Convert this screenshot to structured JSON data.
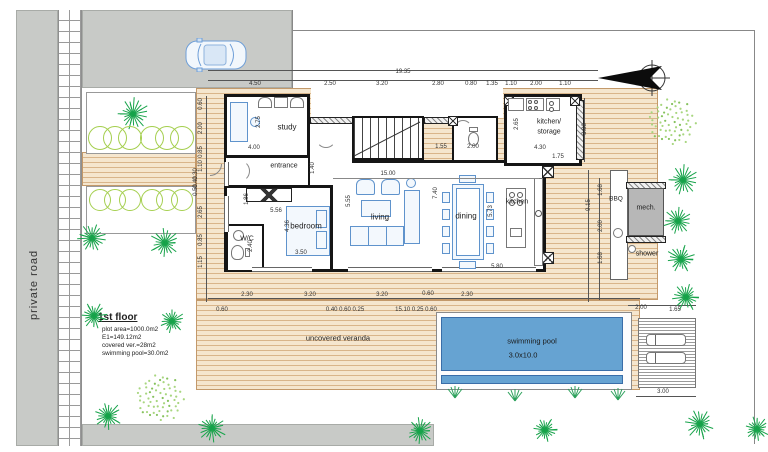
{
  "labels": {
    "road": "private road",
    "veranda": "uncovered veranda",
    "rooms": {
      "study": "study",
      "entrance": "entrance",
      "bedroom": "bedroom",
      "wc": "W/C",
      "living": "living",
      "dining": "dining",
      "kitchen": "kitchen",
      "kitchen_storage_1": "kitchen/",
      "kitchen_storage_2": "storage",
      "mech": "mech.",
      "shower": "shower",
      "bbq": "BBQ"
    },
    "pool": {
      "name": "swimming pool",
      "size": "3.0x10.0"
    }
  },
  "info_block": {
    "title": "1st floor",
    "lines": [
      "plot area=1000.0m2",
      "E1=149.12m2",
      "covered ver.=28m2",
      "swimming pool=30.0m2"
    ]
  },
  "dimensions": {
    "total_width": "19.35",
    "top_chain": [
      "4.50",
      "2.50",
      "3.20",
      "2.80",
      "0.80",
      "1.35",
      "1.10",
      "2.00",
      "1.10"
    ],
    "bottom_chain": [
      "2.30",
      "3.20",
      "3.20",
      "0.60",
      "2.30"
    ],
    "bottom_sub": [
      "0.60",
      "0.40 0.60 0.25",
      "15.10 0.25 0.60"
    ],
    "left_chain": [
      "0.60",
      "2.00",
      "0.85",
      "1.10",
      "0.30",
      "0.40",
      "0.50",
      "2.65",
      "0.85",
      "1.15"
    ],
    "right_chain": [
      "3.88",
      "9.15",
      "1.68",
      "2.00",
      "1.68"
    ],
    "pool_chain": [
      "2.00",
      "1.65",
      "3.00"
    ]
  },
  "dim_labels": [
    {
      "t": "19.35",
      "x": 403,
      "y": 72,
      "v": false
    },
    {
      "t": "4.50",
      "x": 255,
      "y": 84,
      "v": false
    },
    {
      "t": "2.50",
      "x": 330,
      "y": 84,
      "v": false
    },
    {
      "t": "3.20",
      "x": 382,
      "y": 84,
      "v": false
    },
    {
      "t": "2.80",
      "x": 438,
      "y": 84,
      "v": false
    },
    {
      "t": "0.80",
      "x": 471,
      "y": 84,
      "v": false
    },
    {
      "t": "1.35",
      "x": 492,
      "y": 84,
      "v": false
    },
    {
      "t": "1.10",
      "x": 511,
      "y": 84,
      "v": false
    },
    {
      "t": "2.00",
      "x": 536,
      "y": 84,
      "v": false
    },
    {
      "t": "1.10",
      "x": 565,
      "y": 84,
      "v": false
    },
    {
      "t": "2.30",
      "x": 247,
      "y": 295,
      "v": false
    },
    {
      "t": "3.20",
      "x": 310,
      "y": 295,
      "v": false
    },
    {
      "t": "3.20",
      "x": 382,
      "y": 295,
      "v": false
    },
    {
      "t": "0.60",
      "x": 428,
      "y": 294,
      "v": false
    },
    {
      "t": "2.30",
      "x": 467,
      "y": 295,
      "v": false
    },
    {
      "t": "0.60",
      "x": 222,
      "y": 310,
      "v": false
    },
    {
      "t": "0.40 0.60 0.25",
      "x": 345,
      "y": 310,
      "v": false
    },
    {
      "t": "15.10 0.25 0.60",
      "x": 416,
      "y": 310,
      "v": false
    },
    {
      "t": "0.60",
      "x": 201,
      "y": 104,
      "v": true
    },
    {
      "t": "2.00",
      "x": 201,
      "y": 128,
      "v": true
    },
    {
      "t": "0.85",
      "x": 201,
      "y": 152,
      "v": true
    },
    {
      "t": "1.10",
      "x": 201,
      "y": 166,
      "v": true
    },
    {
      "t": "0.30",
      "x": 196,
      "y": 174,
      "v": true
    },
    {
      "t": "0.40",
      "x": 196,
      "y": 182,
      "v": true
    },
    {
      "t": "0.50",
      "x": 196,
      "y": 190,
      "v": true
    },
    {
      "t": "2.65",
      "x": 201,
      "y": 212,
      "v": true
    },
    {
      "t": "0.85",
      "x": 201,
      "y": 240,
      "v": true
    },
    {
      "t": "1.15",
      "x": 201,
      "y": 262,
      "v": true
    },
    {
      "t": "3.88",
      "x": 585,
      "y": 129,
      "v": true
    },
    {
      "t": "9.15",
      "x": 589,
      "y": 205,
      "v": true
    },
    {
      "t": "1.68",
      "x": 601,
      "y": 190,
      "v": true
    },
    {
      "t": "2.00",
      "x": 601,
      "y": 226,
      "v": true
    },
    {
      "t": "1.68",
      "x": 601,
      "y": 258,
      "v": true
    },
    {
      "t": "2.00",
      "x": 641,
      "y": 308,
      "v": false
    },
    {
      "t": "1.65",
      "x": 675,
      "y": 310,
      "v": false
    },
    {
      "t": "3.00",
      "x": 663,
      "y": 392,
      "v": false
    },
    {
      "t": "2.75",
      "x": 259,
      "y": 122,
      "v": true
    },
    {
      "t": "4.00",
      "x": 254,
      "y": 148,
      "v": false
    },
    {
      "t": "1.40",
      "x": 313,
      "y": 168,
      "v": true
    },
    {
      "t": "1.55",
      "x": 441,
      "y": 147,
      "v": false
    },
    {
      "t": "2.00",
      "x": 473,
      "y": 147,
      "v": false
    },
    {
      "t": "2.65",
      "x": 517,
      "y": 124,
      "v": true
    },
    {
      "t": "4.30",
      "x": 540,
      "y": 148,
      "v": false
    },
    {
      "t": "1.75",
      "x": 558,
      "y": 157,
      "v": false
    },
    {
      "t": "1.86",
      "x": 247,
      "y": 199,
      "v": true
    },
    {
      "t": "5.56",
      "x": 276,
      "y": 211,
      "v": false
    },
    {
      "t": "4.36",
      "x": 288,
      "y": 226,
      "v": true
    },
    {
      "t": "2.40",
      "x": 251,
      "y": 246,
      "v": true
    },
    {
      "t": "3.50",
      "x": 301,
      "y": 253,
      "v": false
    },
    {
      "t": "15.00",
      "x": 388,
      "y": 174,
      "v": false
    },
    {
      "t": "5.55",
      "x": 349,
      "y": 201,
      "v": true
    },
    {
      "t": "7.40",
      "x": 436,
      "y": 193,
      "v": true
    },
    {
      "t": "5.73",
      "x": 491,
      "y": 211,
      "v": true
    },
    {
      "t": "5.80",
      "x": 497,
      "y": 267,
      "v": false
    }
  ],
  "decor": {
    "trees": [
      [
        133,
        114,
        17
      ],
      [
        92,
        238,
        15
      ],
      [
        165,
        243,
        16
      ],
      [
        94,
        316,
        14
      ],
      [
        172,
        321,
        13
      ],
      [
        108,
        416,
        15
      ],
      [
        212,
        428,
        15
      ],
      [
        420,
        431,
        14
      ],
      [
        545,
        430,
        13
      ],
      [
        683,
        180,
        16
      ],
      [
        678,
        221,
        15
      ],
      [
        681,
        259,
        15
      ],
      [
        686,
        297,
        15
      ],
      [
        700,
        424,
        16
      ],
      [
        757,
        429,
        13
      ]
    ],
    "bushes": [
      [
        672,
        122,
        26
      ],
      [
        160,
        398,
        26
      ]
    ],
    "grass": [
      [
        455,
        396
      ],
      [
        515,
        399
      ],
      [
        575,
        396
      ],
      [
        618,
        398
      ]
    ],
    "shrub_rows": [
      {
        "y": 138,
        "r": 12,
        "xs": [
          100,
          115,
          130,
          152,
          167,
          182
        ]
      },
      {
        "y": 200,
        "r": 11,
        "xs": [
          100,
          115,
          130,
          152,
          167,
          182
        ]
      }
    ]
  },
  "colors": {
    "road": "#c8cac7",
    "deck_line": "#d9b58a",
    "pool": "#66a3d2",
    "wall": "#151515",
    "furniture": "#5f93cc",
    "tree": "#17a34a",
    "shrub": "#a5cf4f"
  }
}
